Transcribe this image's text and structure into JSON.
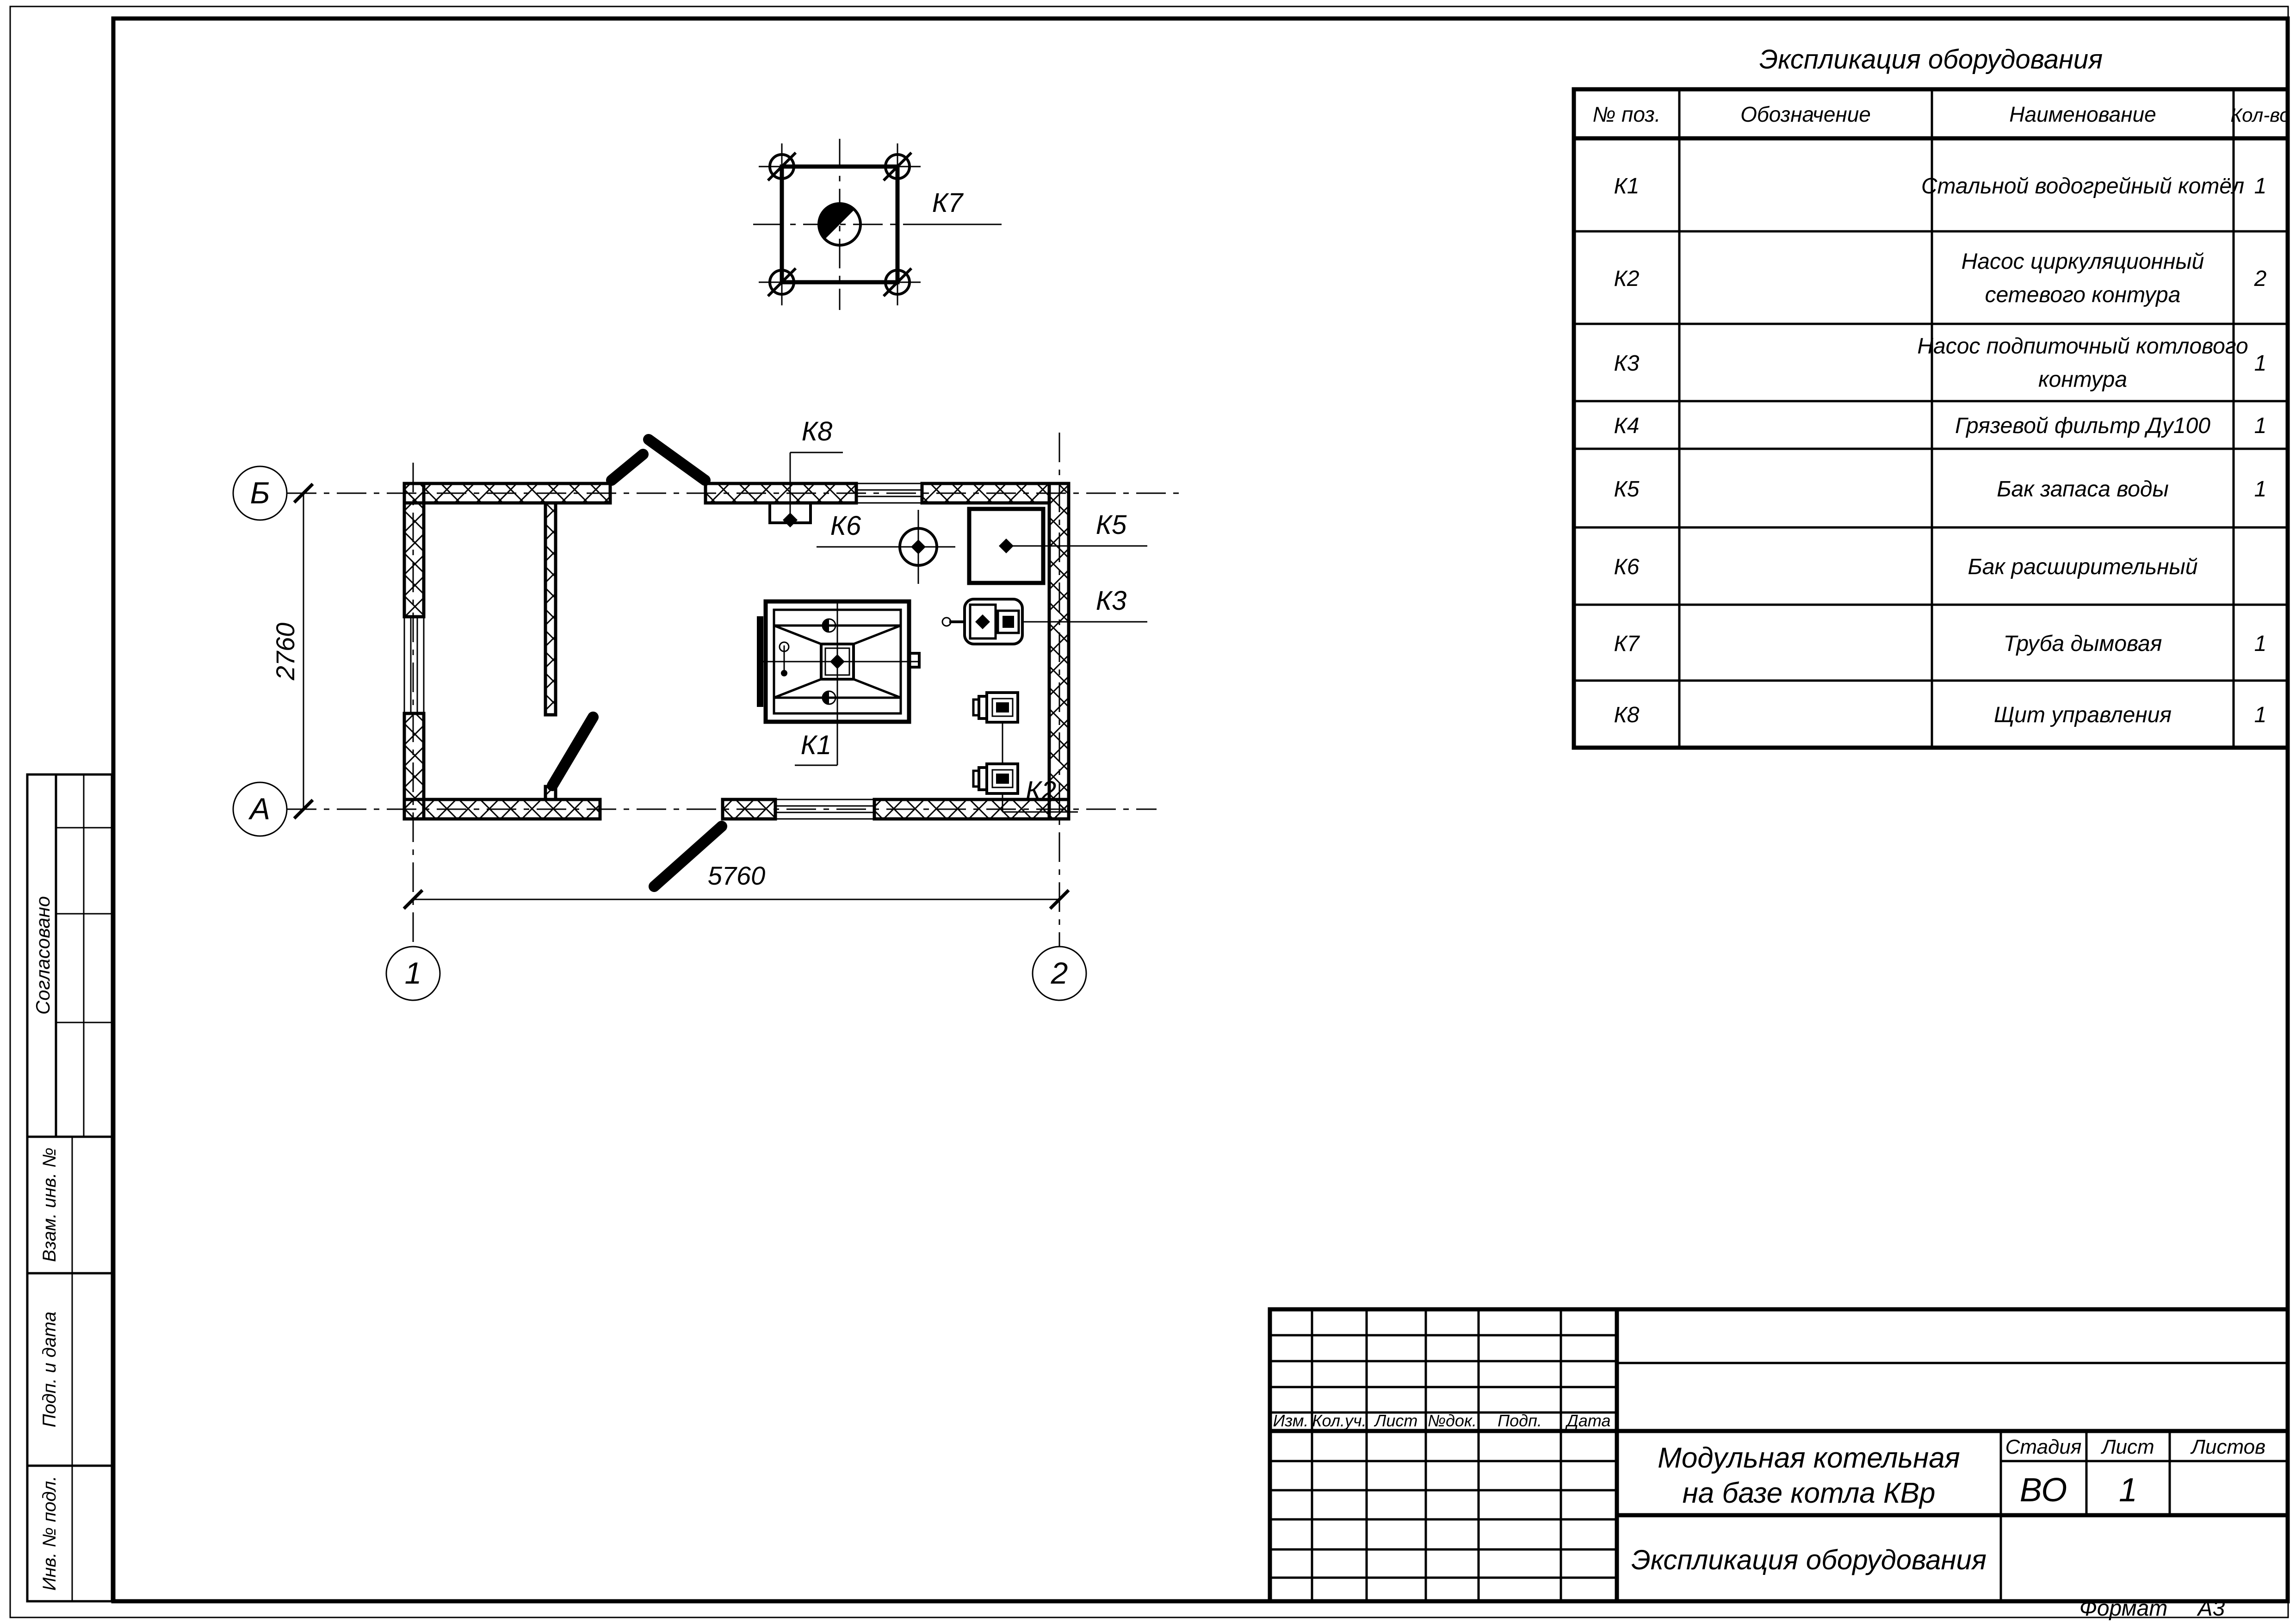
{
  "equipment_table": {
    "title": "Экспликация оборудования",
    "columns": [
      "№ поз.",
      "Обозначение",
      "Наименование",
      "Кол-во"
    ],
    "rows": [
      {
        "pos": "К1",
        "designation": "",
        "name": "Стальной водогрейный котёл",
        "name2": "",
        "qty": "1"
      },
      {
        "pos": "К2",
        "designation": "",
        "name": "Насос циркуляционный",
        "name2": "сетевого контура",
        "qty": "2"
      },
      {
        "pos": "К3",
        "designation": "",
        "name": "Насос подпиточный котлового",
        "name2": "контура",
        "qty": "1"
      },
      {
        "pos": "К4",
        "designation": "",
        "name": "Грязевой фильтр Ду100",
        "name2": "",
        "qty": "1"
      },
      {
        "pos": "К5",
        "designation": "",
        "name": "Бак запаса воды",
        "name2": "",
        "qty": "1"
      },
      {
        "pos": "К6",
        "designation": "",
        "name": "Бак расширительный",
        "name2": "",
        "qty": ""
      },
      {
        "pos": "К7",
        "designation": "",
        "name": "Труба дымовая",
        "name2": "",
        "qty": "1"
      },
      {
        "pos": "К8",
        "designation": "",
        "name": "Щит управления",
        "name2": "",
        "qty": "1"
      }
    ]
  },
  "plan": {
    "axes": {
      "top_left": "Б",
      "bottom_left": "А",
      "col_1": "1",
      "col_2": "2"
    },
    "dimensions": {
      "height": "2760",
      "width": "5760"
    },
    "labels": {
      "k1": "К1",
      "k2": "К2",
      "k3": "К3",
      "k5": "К5",
      "k6": "К6",
      "k7": "К7",
      "k8": "К8"
    }
  },
  "title_block": {
    "revision_headers": [
      "Изм.",
      "Кол.уч.",
      "Лист",
      "№док.",
      "Подп.",
      "Дата"
    ],
    "project_title_line1": "Модульная котельная",
    "project_title_line2": "на базе котла КВр",
    "doc_title": "Экспликация оборудования",
    "stage_header": "Стадия",
    "sheet_header": "Лист",
    "sheets_header": "Листов",
    "stage_value": "ВО",
    "sheet_value": "1",
    "sheets_value": ""
  },
  "side_strip": {
    "approved": "Согласовано",
    "replace_inv": "Взам. инв. №",
    "sign_date": "Подп. и дата",
    "inv_orig": "Инв. № подл."
  },
  "footer": {
    "format_label": "Формат",
    "format_value": "А3"
  }
}
